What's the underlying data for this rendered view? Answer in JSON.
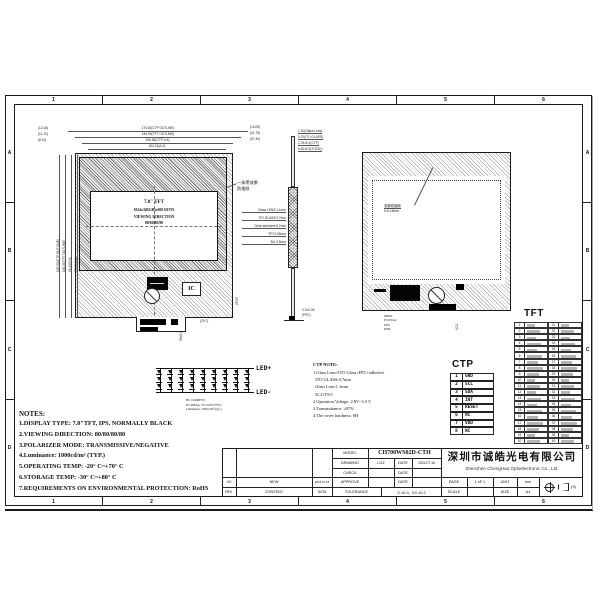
{
  "sheet": {
    "zones_h": [
      "1",
      "2",
      "3",
      "4",
      "5",
      "6"
    ],
    "zones_v": [
      "A",
      "B",
      "C",
      "D"
    ]
  },
  "front_view": {
    "display": {
      "line1": "7.0\" TFT",
      "line2": "1024x3(RGB)x600 DOTS",
      "line3": "VIEWING DIRECTION",
      "line4": "80/80/80/80"
    },
    "bezel_label": [
      "一体黑效果",
      "防指纹"
    ],
    "ic_label": "IC",
    "dims_top": [
      "170.40(CTP OUTLINE)",
      "164.90(TFT OUTLINE)",
      "156.96(CTP V.A)",
      "154.21(A.A)"
    ],
    "dims_left": [
      "105.50(CTP OUTLINE)",
      "100.00(TFT OUTLINE)",
      "91.44(V.A)",
      "85.92(A.A)"
    ],
    "stack_right": [
      "(16.05)",
      "(21.75)",
      "(57.40)"
    ],
    "stack_left": [
      "(13.16)",
      "(11.10)",
      "(8.10)"
    ],
    "dim_bottom": "(29.7)",
    "dim_bottom_rot": "30±0.5",
    "dim_right_rot": "25.95"
  },
  "side_view": {
    "dims_top": [
      "1.10(Glass Lens)",
      "0.70(ITO GLASS)",
      "1.76±0.1(CTP)",
      "5.50±0.3(TOTAL)"
    ],
    "layers": [
      "Glass LENS:1.1mm",
      "ITO GLASS:0.7mm",
      "Clear adhesive:0.2mm",
      "TFT:2.05mm",
      "B/L:2.5mm"
    ],
    "dims_bottom": [
      "0.3±0.05",
      "(FPC)"
    ]
  },
  "back_view": {
    "label": [
      "泡棉双面胶",
      "t=0.15mm"
    ],
    "dims_bottom": [
      "40PIN",
      "P=0.5mm",
      "FPC",
      "PIN1"
    ],
    "dim_side": "10.2"
  },
  "led_circuit": {
    "anode": "LED+",
    "cathode": "LED-",
    "rows": 3,
    "cols": 9,
    "note": [
      "BL CURRENT:",
      "IF=300mA, VF=9.6V(TYP.)",
      "Luminance: 1000cd/m²(typ.)"
    ]
  },
  "ctp_note": {
    "title": "CTP NOTE:",
    "lines": [
      "1.Glass Lens+ITO Glass+FPC+adhesive",
      "  ITO GLASS:0.7mm",
      "  Glass Lens:1.1mm",
      "  IC:GT911",
      "2.Operation Voltage: 2.8V~3.3 V",
      "3.Transmittance: ≥87%",
      "4.The cover hardness: 6H"
    ]
  },
  "ctp_table": {
    "title": "CTP",
    "pins": [
      [
        "1",
        "GND"
      ],
      [
        "2",
        "SCL"
      ],
      [
        "3",
        "SDA"
      ],
      [
        "4",
        "INT"
      ],
      [
        "5",
        "RESET"
      ],
      [
        "6",
        "NC"
      ],
      [
        "7",
        "VDD"
      ],
      [
        "8",
        "NC"
      ]
    ]
  },
  "tft_table": {
    "title": "TFT",
    "left_pins": [
      "1",
      "2",
      "3",
      "4",
      "5",
      "6",
      "7",
      "8",
      "9",
      "10",
      "11",
      "12",
      "13",
      "14",
      "15",
      "16",
      "17",
      "18",
      "19",
      "20"
    ],
    "right_pins": [
      "21",
      "22",
      "23",
      "24",
      "25",
      "26",
      "27",
      "28",
      "29",
      "30",
      "31",
      "32",
      "33",
      "34",
      "35",
      "36",
      "37",
      "38",
      "39",
      "40"
    ]
  },
  "notes": {
    "title": "NOTES:",
    "lines": [
      "1.DISPLAY TYPE:  7.0\"TFT, IPS, NORMALLY BLACK",
      "2.VIEWING DIRECTION: 80/80/80/80",
      "3.POLARIZER MODE: TRANSMISSIVE/NEGATIVE",
      "4.Luminance: 1000cd/m² (TYP.)",
      "5.OPERATING TEMP: -20° C~+70° C",
      "6.STORAGE TEMP: -30° C~+80° C",
      "7.REQUIREMENTS ON ENVIRONMENTAL PROTECTION: RoHS"
    ]
  },
  "title_block": {
    "model_label": "MODEL",
    "model": "CH700WS02D-CTH",
    "drawing_label": "DRAWING",
    "drawing_by": "LGZ",
    "date_label": "DATE",
    "drawing_date": "2024.07.16",
    "check_label": "CHECK",
    "approve_label": "APPROVE",
    "tolerance_label": "TOLERANCE",
    "tolerance": ".X ±0.3, .XX ±0.2",
    "rev": "V0",
    "rev_content": "NEW",
    "rev_date": "2024.07.16",
    "rev_label": "REV.",
    "content_label": "CONTENT",
    "data_label": "DATA",
    "company_cn": "深圳市诚皓光电有限公司",
    "company_en": "Shenzhen ChengHao Optoelectronic Co., Ltd.",
    "page_label": "PAGE",
    "page": "1 oF 1",
    "unit_label": "UNIT",
    "unit": "mm",
    "scale_label": "SCALE",
    "size_label": "SIZE",
    "size": "A4",
    "projection_note": "(3)"
  }
}
